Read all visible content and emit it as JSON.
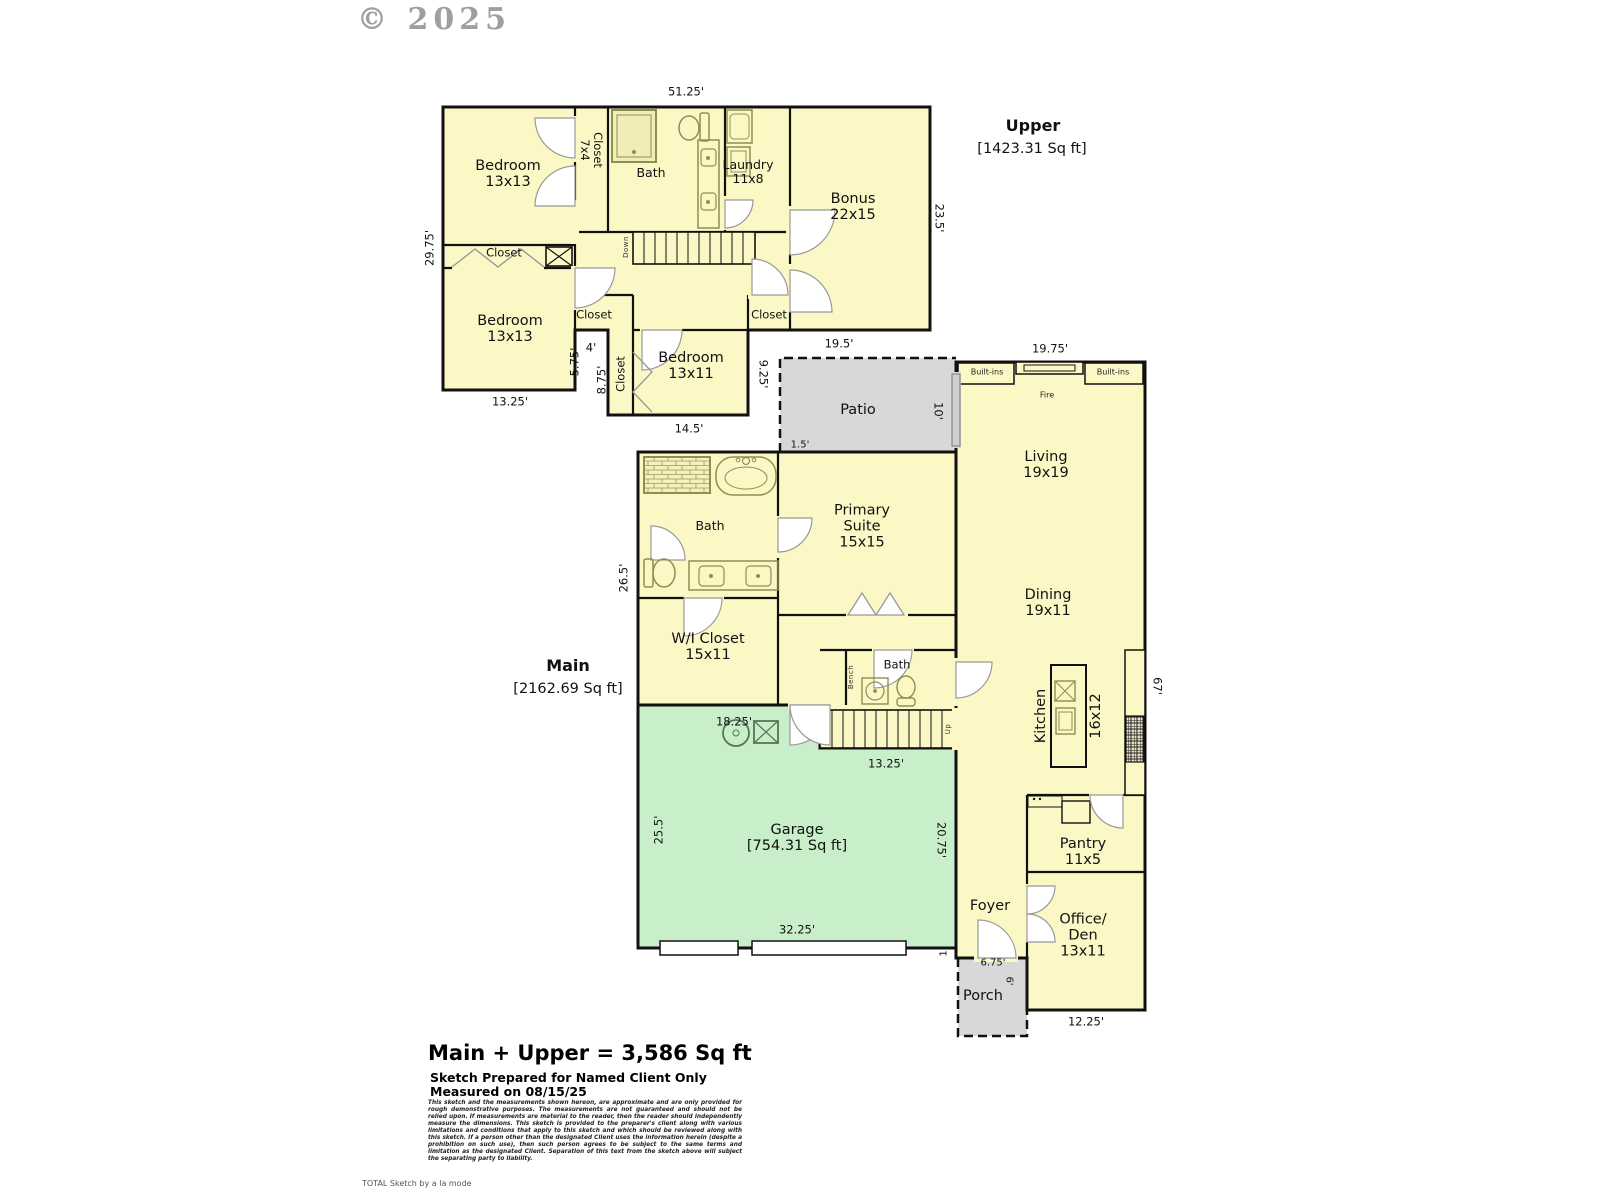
{
  "copyright": "© 2025",
  "colors": {
    "room_fill": "#FBF8C5",
    "garage_fill": "#C9EECA",
    "outdoor_fill": "#D8D8D8",
    "wall": "#111111",
    "fixture": "#8F8F4F"
  },
  "upper": {
    "title": "Upper",
    "area": "[1423.31 Sq ft]",
    "rooms": {
      "bedroom_tl": "Bedroom\n13x13",
      "closet_7x4": "Closet\n7x4",
      "bath": "Bath",
      "laundry": "Laundry\n11x8",
      "bonus": "Bonus\n22x15",
      "closet_left": "Closet",
      "bedroom_ll": "Bedroom\n13x13",
      "closet_mid": "Closet",
      "closet_right": "Closet",
      "bedroom_mid": "Bedroom\n13x11",
      "closet_vert": "Closet",
      "stairs": "Down"
    },
    "dims": {
      "top": "51.25'",
      "left": "29.75'",
      "right": "23.5'",
      "notch_w": "4'",
      "notch_h": "5.75'",
      "closet_h": "8.75'",
      "bed_ll_w": "13.25'",
      "bed_mid_w": "14.5'",
      "bonus_w": "19.5'",
      "bed_mid_h": "9.25'"
    }
  },
  "main": {
    "title": "Main",
    "area": "[2162.69 Sq ft]",
    "rooms": {
      "patio": "Patio",
      "living": "Living\n19x19",
      "dining": "Dining\n19x11",
      "kitchen": "Kitchen",
      "kitchen_size": "16x12",
      "primary": "Primary\nSuite\n15x15",
      "bath": "Bath",
      "wi_closet": "W/I Closet\n15x11",
      "bath2": "Bath",
      "bench": "Bench",
      "stairs": "Up",
      "garage": "Garage\n[754.31 Sq ft]",
      "foyer": "Foyer",
      "pantry": "Pantry\n11x5",
      "office": "Office/\nDen\n13x11",
      "porch": "Porch",
      "builtins_left": "Built-ins",
      "builtins_right": "Built-ins",
      "fireplace": "Fire"
    },
    "dims": {
      "living_w": "19.75'",
      "patio_h": "10'",
      "patio_off": "1.5'",
      "left_h": "26.5'",
      "right_h": "67'",
      "stairs_w": "13.25'",
      "garage_top": "18.25'",
      "garage_left": "25.5'",
      "garage_right": "20.75'",
      "garage_w": "32.25'",
      "step": "1'",
      "porch_w": "6.75'",
      "porch_h": "6'",
      "office_w": "12.25'"
    }
  },
  "footer": {
    "total": "Main + Upper = 3,586 Sq ft",
    "prepared": "Sketch Prepared for Named Client Only",
    "measured": "Measured on 08/15/25",
    "disclaimer": "This sketch and the measurements shown hereon, are approximate and are only provided for rough demonstrative purposes. The measurements are not guaranteed and should not be relied upon. If measurements are material to the reader, then the reader should independently measure the dimensions. This sketch is provided to the preparer's client along with various limitations and conditions that apply to this sketch and which should be reviewed along with this sketch. If a person other than the designated Client uses the information herein (despite a prohibition on such use), then such person agrees to be subject to the same terms and limitation as the designated Client. Separation of this text from the sketch above will subject the separating party to liability.",
    "brand": "TOTAL Sketch by a la mode"
  }
}
